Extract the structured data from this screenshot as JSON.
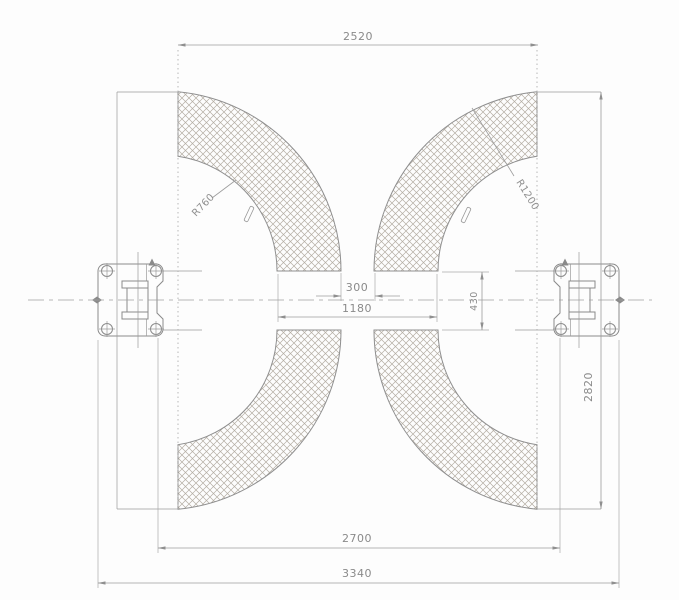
{
  "drawing": {
    "type": "two-post-car-lift-plan-view",
    "dimensions": {
      "top_width": "2520",
      "arm_gap": "300",
      "inner_span": "1180",
      "pivot_spacing": "430",
      "sweep_depth": "2820",
      "post_span": "2700",
      "overall_width": "3340"
    },
    "radii": {
      "inner_arc": "R760",
      "outer_arc": "R1200"
    },
    "colors": {
      "object_line": "#8a8a8a",
      "dimension_line": "#9c9c9c",
      "hatch": "#b4ada3",
      "text": "#8a8a8a",
      "background": "#fdfdfd"
    }
  }
}
